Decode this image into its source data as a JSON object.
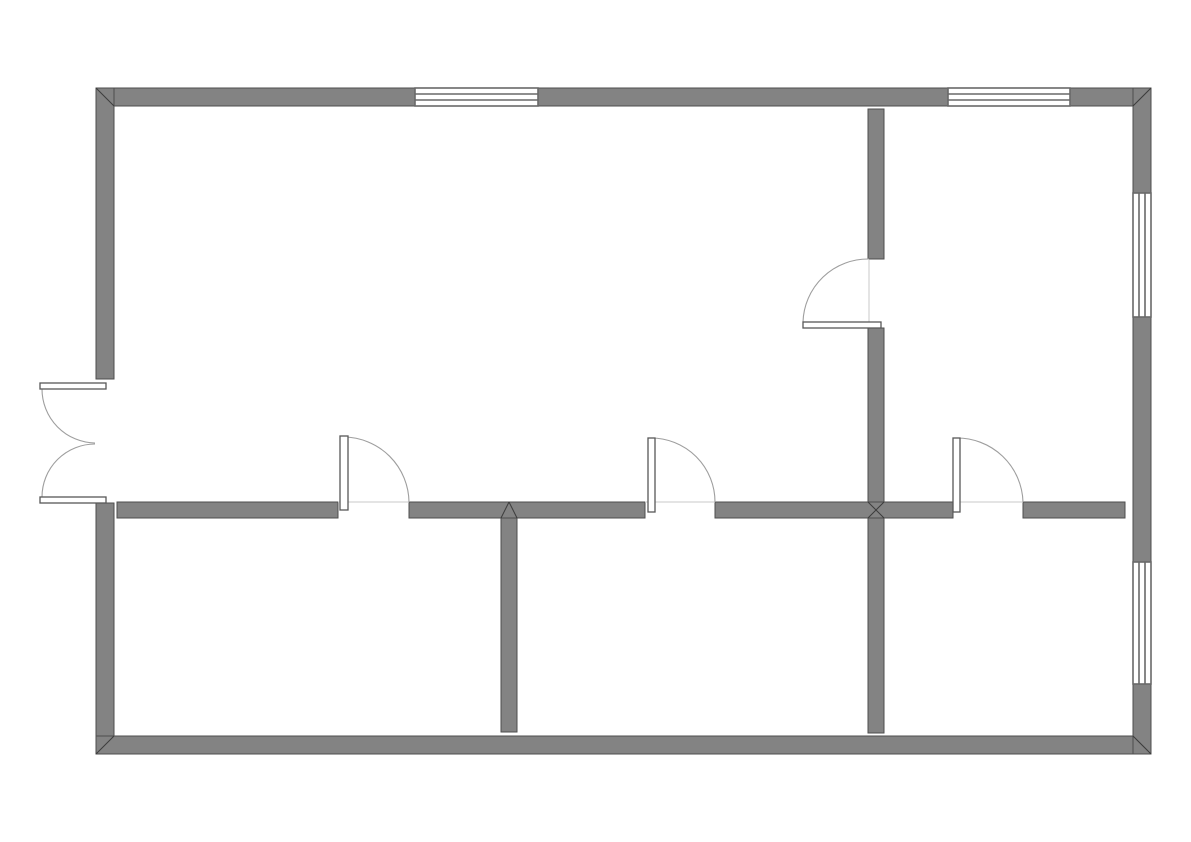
{
  "canvas": {
    "width": 1191,
    "height": 842,
    "background": "#ffffff"
  },
  "style": {
    "wall_fill": "#838383",
    "wall_edge": "#4e4e4e",
    "window_fill": "#ffffff",
    "window_frame": "#696969",
    "leaf_fill": "#ffffff",
    "leaf_edge": "#585858",
    "swing_arc": "#9e9e9e",
    "threshold": "#c9c9c9",
    "miter": "#3c3c3c"
  },
  "walls": [
    {
      "name": "exterior-wall-top-left",
      "x": 96,
      "y": 88,
      "w": 319,
      "h": 18
    },
    {
      "name": "exterior-wall-top-middle",
      "x": 538,
      "y": 88,
      "w": 410,
      "h": 18
    },
    {
      "name": "exterior-wall-top-right",
      "x": 1070,
      "y": 88,
      "w": 81,
      "h": 18
    },
    {
      "name": "exterior-wall-left-upper",
      "x": 96,
      "y": 88,
      "w": 18,
      "h": 291
    },
    {
      "name": "exterior-wall-left-lower",
      "x": 96,
      "y": 503,
      "w": 18,
      "h": 251
    },
    {
      "name": "exterior-wall-bottom",
      "x": 96,
      "y": 736,
      "w": 1055,
      "h": 18
    },
    {
      "name": "exterior-wall-right-upper",
      "x": 1133,
      "y": 88,
      "w": 18,
      "h": 105
    },
    {
      "name": "exterior-wall-right-middle",
      "x": 1133,
      "y": 317,
      "w": 18,
      "h": 245
    },
    {
      "name": "exterior-wall-right-lower",
      "x": 1133,
      "y": 684,
      "w": 18,
      "h": 70
    },
    {
      "name": "interior-wall-horizontal-1",
      "x": 117,
      "y": 502,
      "w": 221,
      "h": 16
    },
    {
      "name": "interior-wall-horizontal-2",
      "x": 409,
      "y": 502,
      "w": 236,
      "h": 16
    },
    {
      "name": "interior-wall-horizontal-3",
      "x": 715,
      "y": 502,
      "w": 238,
      "h": 16
    },
    {
      "name": "interior-wall-horizontal-4",
      "x": 1023,
      "y": 502,
      "w": 102,
      "h": 16
    },
    {
      "name": "interior-wall-vertical-left",
      "x": 501,
      "y": 518,
      "w": 16,
      "h": 214
    },
    {
      "name": "interior-wall-vertical-right-upper",
      "x": 868,
      "y": 109,
      "w": 16,
      "h": 150
    },
    {
      "name": "interior-wall-vertical-right-mid",
      "x": 868,
      "y": 328,
      "w": 16,
      "h": 174
    },
    {
      "name": "interior-wall-vertical-right-lower",
      "x": 868,
      "y": 518,
      "w": 16,
      "h": 215
    }
  ],
  "windows": [
    {
      "name": "window-top-left",
      "x": 415,
      "y": 88,
      "w": 123,
      "h": 18,
      "dir": "h"
    },
    {
      "name": "window-top-right",
      "x": 948,
      "y": 88,
      "w": 122,
      "h": 18,
      "dir": "h"
    },
    {
      "name": "window-right-upper",
      "x": 1133,
      "y": 193,
      "w": 18,
      "h": 124,
      "dir": "v"
    },
    {
      "name": "window-right-lower",
      "x": 1133,
      "y": 562,
      "w": 18,
      "h": 122,
      "dir": "v"
    }
  ],
  "doors": [
    {
      "name": "entry-double-door-top-leaf",
      "leaf": [
        40,
        383,
        66,
        6
      ],
      "arc": "M 42 389 A 54 54 0 0 0 95 443"
    },
    {
      "name": "entry-double-door-bottom-leaf",
      "leaf": [
        40,
        497,
        66,
        6
      ],
      "arc": "M 42 497 A 53 53 0 0 1 95 444"
    },
    {
      "name": "door-bottom-left-room",
      "leaf": [
        340,
        436,
        8,
        74
      ],
      "arc": "M 344 437 A 66 66 0 0 1 409 502",
      "line": [
        338,
        502,
        409,
        502
      ]
    },
    {
      "name": "door-bottom-middle-room",
      "leaf": [
        648,
        438,
        7,
        74
      ],
      "arc": "M 651 438 A 64 64 0 0 1 715 502",
      "line": [
        645,
        502,
        715,
        502
      ]
    },
    {
      "name": "door-bottom-right-room",
      "leaf": [
        953,
        438,
        7,
        74
      ],
      "arc": "M 956 438 A 66 66 0 0 1 1023 502",
      "line": [
        953,
        502,
        1023,
        502
      ]
    },
    {
      "name": "door-top-right-room",
      "leaf": [
        803,
        322,
        78,
        6
      ],
      "arc": "M 803 322 A 65 65 0 0 1 869 259",
      "line": [
        869,
        260,
        869,
        322
      ]
    }
  ],
  "miters": [
    {
      "name": "miter-corner-top-left",
      "x1": 96,
      "y1": 88,
      "x2": 114,
      "y2": 106
    },
    {
      "name": "miter-corner-top-right",
      "x1": 1151,
      "y1": 88,
      "x2": 1133,
      "y2": 106
    },
    {
      "name": "miter-corner-bottom-left",
      "x1": 96,
      "y1": 754,
      "x2": 114,
      "y2": 736
    },
    {
      "name": "miter-corner-bottom-right",
      "x1": 1151,
      "y1": 754,
      "x2": 1133,
      "y2": 736
    },
    {
      "name": "miter-t-junction-left-a",
      "x1": 501,
      "y1": 518,
      "x2": 509,
      "y2": 502
    },
    {
      "name": "miter-t-junction-left-b",
      "x1": 509,
      "y1": 502,
      "x2": 517,
      "y2": 518
    },
    {
      "name": "miter-x-junction-a",
      "x1": 868,
      "y1": 502,
      "x2": 884,
      "y2": 518
    },
    {
      "name": "miter-x-junction-b",
      "x1": 884,
      "y1": 502,
      "x2": 868,
      "y2": 518
    }
  ]
}
